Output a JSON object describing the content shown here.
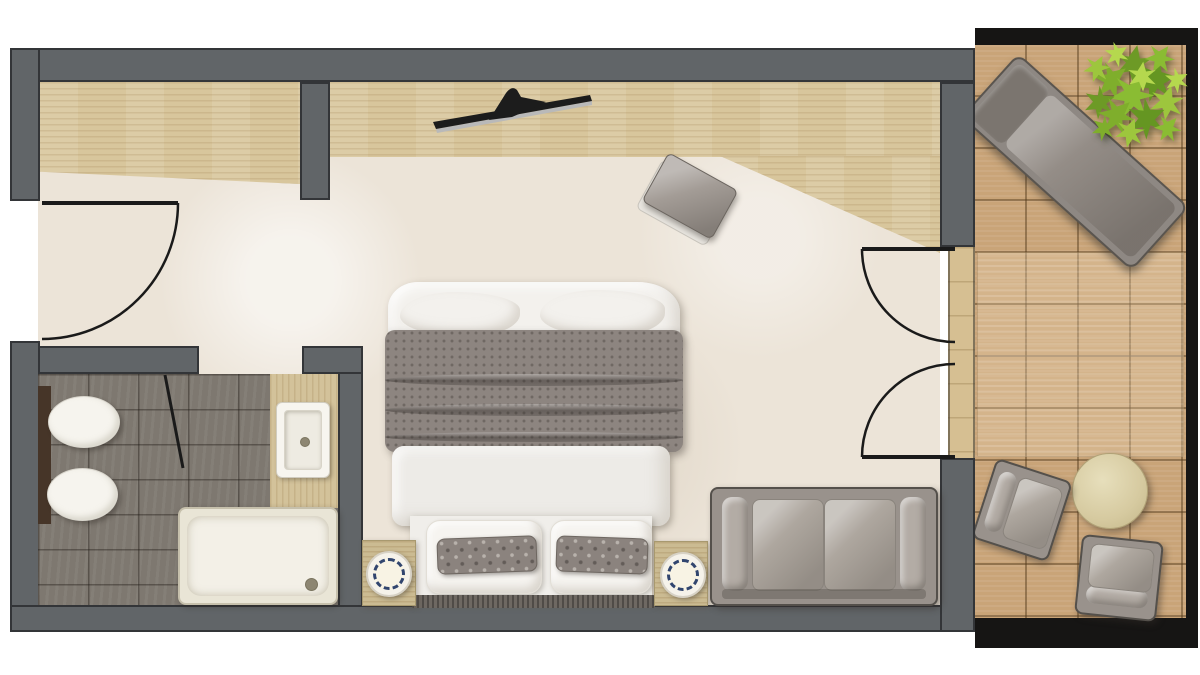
{
  "meta": {
    "scene": "hotel-room-floor-plan-top-view",
    "canvas_width": 1200,
    "canvas_height": 675,
    "visible_text": "none"
  },
  "colors": {
    "wallFill": "#616568",
    "wallEdge": "#333538",
    "carpet": "#ece4d8",
    "woodFloor": "#d8c69c",
    "balconyWood": "#c9a478",
    "balconyRail": "#161514",
    "bathTile": "#7e7870",
    "fixtureWhite": "#f6f4ee",
    "tubRim": "#c6c0ac",
    "furnitureGray": "#99928c",
    "cushionLight": "#b3aca5",
    "blanketGray": "#8d8580",
    "linenWhite": "#f3f1ed",
    "headboard": "#6e6862",
    "nightstandWood": "#cbbb92",
    "lampNavy": "#31456e",
    "plantGreen": "#9dc63d",
    "plantGreenDark": "#6d9a26",
    "tableCream": "#ddd2a6",
    "doorLine": "#1a1a1a",
    "brownLedge": "#463528",
    "tvBlack": "#1c1c1c",
    "tvSilver": "#b9b9b9"
  },
  "rooms": {
    "bedroom": "bedroom-living-area",
    "bathroom": "bathroom",
    "balcony": "balcony-terrace",
    "entry": "entry-hall",
    "wardrobe": "wardrobe-niche"
  },
  "furniture": {
    "bed": "double-bed-with-gray-blanket",
    "pillows": "two-white-and-two-gray-pillows",
    "nightstand_left": "left-bedside-table-with-round-lamp",
    "nightstand_right": "right-bedside-table-with-round-lamp",
    "sofa": "two-seat-gray-sofa",
    "tv": "flat-screen-tv-on-console",
    "stool": "upholstered-ottoman-stool",
    "toilet": "wall-hung-toilet",
    "bidet": "wall-hung-bidet",
    "sink": "vanity-sink-with-wood-counter",
    "bathtub": "bathtub-shower-tray",
    "entry_door": "entry-swing-door",
    "bathroom_door": "bathroom-door-ajar",
    "balcony_door": "double-french-door-to-balcony",
    "lounger": "sun-lounger",
    "plant": "potted-green-plant",
    "side_table": "round-outdoor-table",
    "armchair_1": "outdoor-armchair-upper",
    "armchair_2": "outdoor-armchair-lower"
  }
}
